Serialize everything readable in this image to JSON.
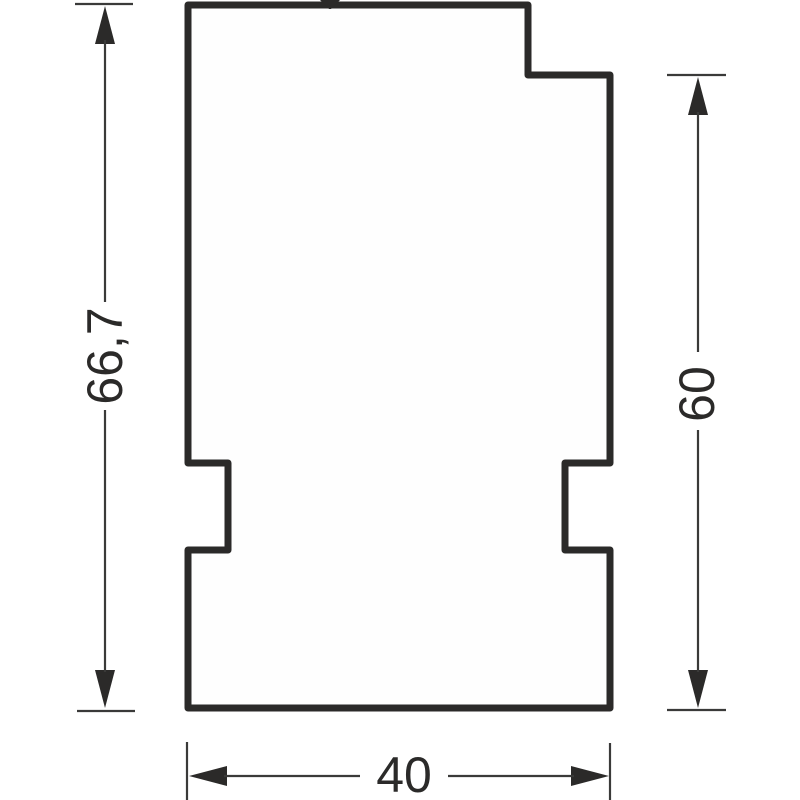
{
  "drawing": {
    "kind": "technical-dimension-drawing",
    "dimensions": {
      "left": {
        "label": "66,7",
        "orientation": "vertical-rotated"
      },
      "right": {
        "label": "60",
        "orientation": "vertical-rotated"
      },
      "bottom": {
        "label": "40",
        "orientation": "horizontal"
      }
    },
    "colors": {
      "outline": "#2b2a29",
      "dimension_lines": "#3a3a39",
      "text": "#2b2a29",
      "background": "#ffffff"
    }
  }
}
